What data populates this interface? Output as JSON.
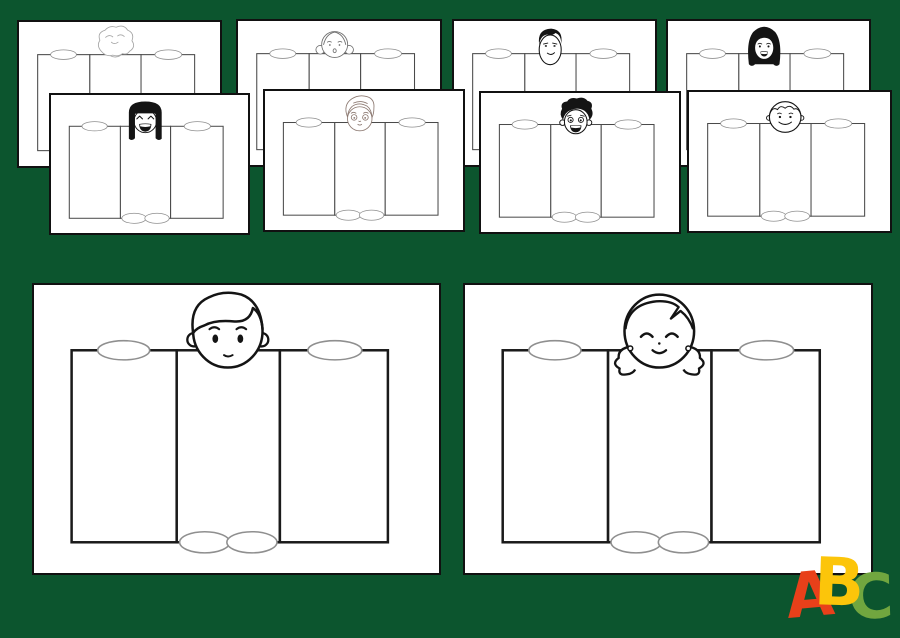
{
  "colors": {
    "background": "#0c552e",
    "card_background": "#ffffff",
    "card_border": "#111111",
    "panel_stroke_small": "#4a4a4a",
    "panel_stroke_large": "#1a1a1a",
    "oval_stroke": "#8f8f8f",
    "logo_a_color": "#e8401a",
    "logo_b_color": "#fcc50a",
    "logo_c_color": "#71a63f"
  },
  "cards": [
    {
      "id": "top-1",
      "row": "back",
      "face": "girl-wavy-hair"
    },
    {
      "id": "top-2",
      "row": "back",
      "face": "girl-side-buns"
    },
    {
      "id": "top-3",
      "row": "back",
      "face": "boy-black-short-hair"
    },
    {
      "id": "top-4",
      "row": "back",
      "face": "girl-black-bob"
    },
    {
      "id": "mid-1",
      "row": "front",
      "face": "girl-black-bangs-laughing"
    },
    {
      "id": "mid-2",
      "row": "front",
      "face": "boy-sketch-hair"
    },
    {
      "id": "mid-3",
      "row": "front",
      "face": "boy-black-curly-hair"
    },
    {
      "id": "mid-4",
      "row": "front",
      "face": "boy-round-face"
    },
    {
      "id": "large-1",
      "row": "large",
      "face": "boy-side-swept-hair"
    },
    {
      "id": "large-2",
      "row": "large",
      "face": "girl-pigtails"
    }
  ],
  "logo": {
    "letters": [
      {
        "char": "A",
        "color": "#e8401a"
      },
      {
        "char": "B",
        "color": "#fcc50a"
      },
      {
        "char": "C",
        "color": "#71a63f"
      }
    ]
  }
}
